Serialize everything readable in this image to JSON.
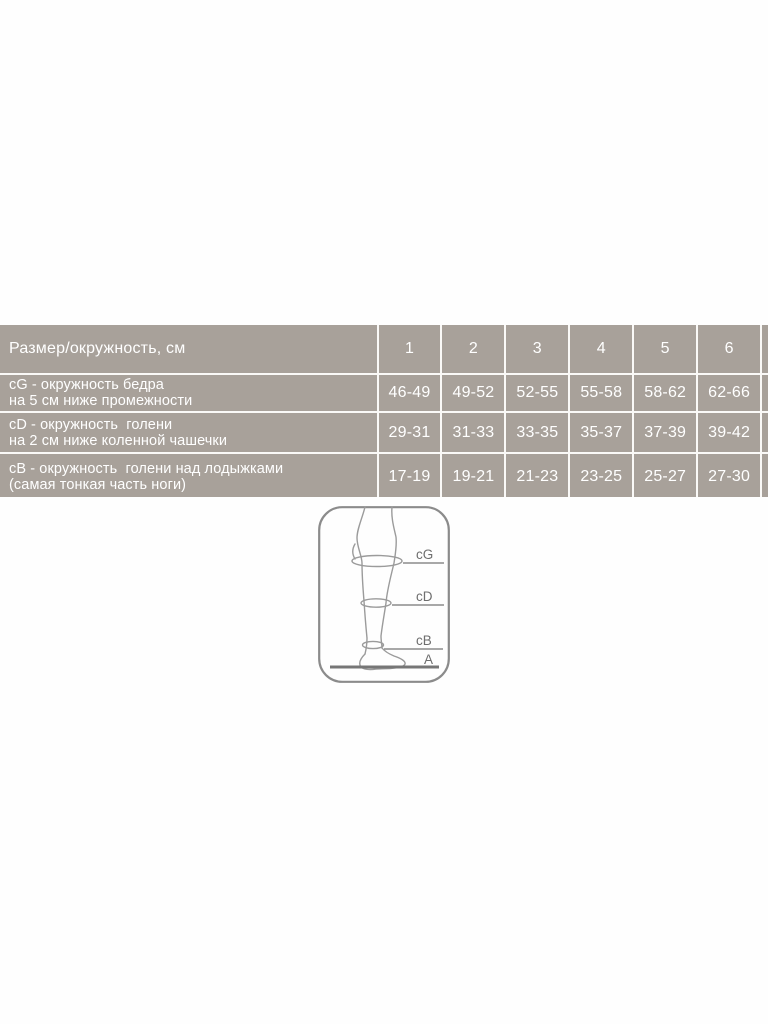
{
  "page": {
    "background": "#fefefe"
  },
  "colors": {
    "band_gray": "#a8a19a",
    "table_line": "#faf9f7",
    "table_text": "#ffffff",
    "diagram_outline": "#8b8b8b",
    "diagram_line_art": "#9b9b9b",
    "diagram_label": "#6e6e6e",
    "floor_line": "#767676"
  },
  "table": {
    "corner_label": "Размер/окружность, см",
    "size_headers": [
      "1",
      "2",
      "3",
      "4",
      "5",
      "6",
      "7"
    ],
    "rows": [
      {
        "id": "cG",
        "label_line1": "cG - окружность бедра",
        "label_line2": "на 5 см ниже промежности",
        "values": [
          "46-49",
          "49-52",
          "52-55",
          "55-58",
          "58-62",
          "62-66",
          ""
        ]
      },
      {
        "id": "cD",
        "label_line1": "cD - окружность  голени",
        "label_line2": "на 2 см ниже коленной чашечки",
        "values": [
          "29-31",
          "31-33",
          "33-35",
          "35-37",
          "37-39",
          "39-42",
          ""
        ]
      },
      {
        "id": "cB",
        "label_line1": "cB - окружность  голени над лодыжками",
        "label_line2": "(самая тонкая часть ноги)",
        "values": [
          "17-19",
          "19-21",
          "21-23",
          "23-25",
          "25-27",
          "27-30",
          ""
        ]
      }
    ]
  },
  "diagram": {
    "labels": {
      "cg": "cG",
      "cd": "cD",
      "cb": "cB",
      "a": "A"
    }
  },
  "chart_data": {
    "type": "table",
    "title": "Размер/окружность, см",
    "columns": [
      "Размер/окружность, см",
      "1",
      "2",
      "3",
      "4",
      "5",
      "6"
    ],
    "rows": [
      [
        "cG - окружность бедра на 5 см ниже промежности",
        "46-49",
        "49-52",
        "52-55",
        "55-58",
        "58-62",
        "62-66"
      ],
      [
        "cD - окружность голени на 2 см ниже коленной чашечки",
        "29-31",
        "31-33",
        "33-35",
        "35-37",
        "37-39",
        "39-42"
      ],
      [
        "cB - окружность голени над лодыжками (самая тонкая часть ноги)",
        "17-19",
        "19-21",
        "21-23",
        "23-25",
        "25-27",
        "27-30"
      ]
    ],
    "annotations": [
      "cG",
      "cD",
      "cB",
      "A"
    ]
  }
}
